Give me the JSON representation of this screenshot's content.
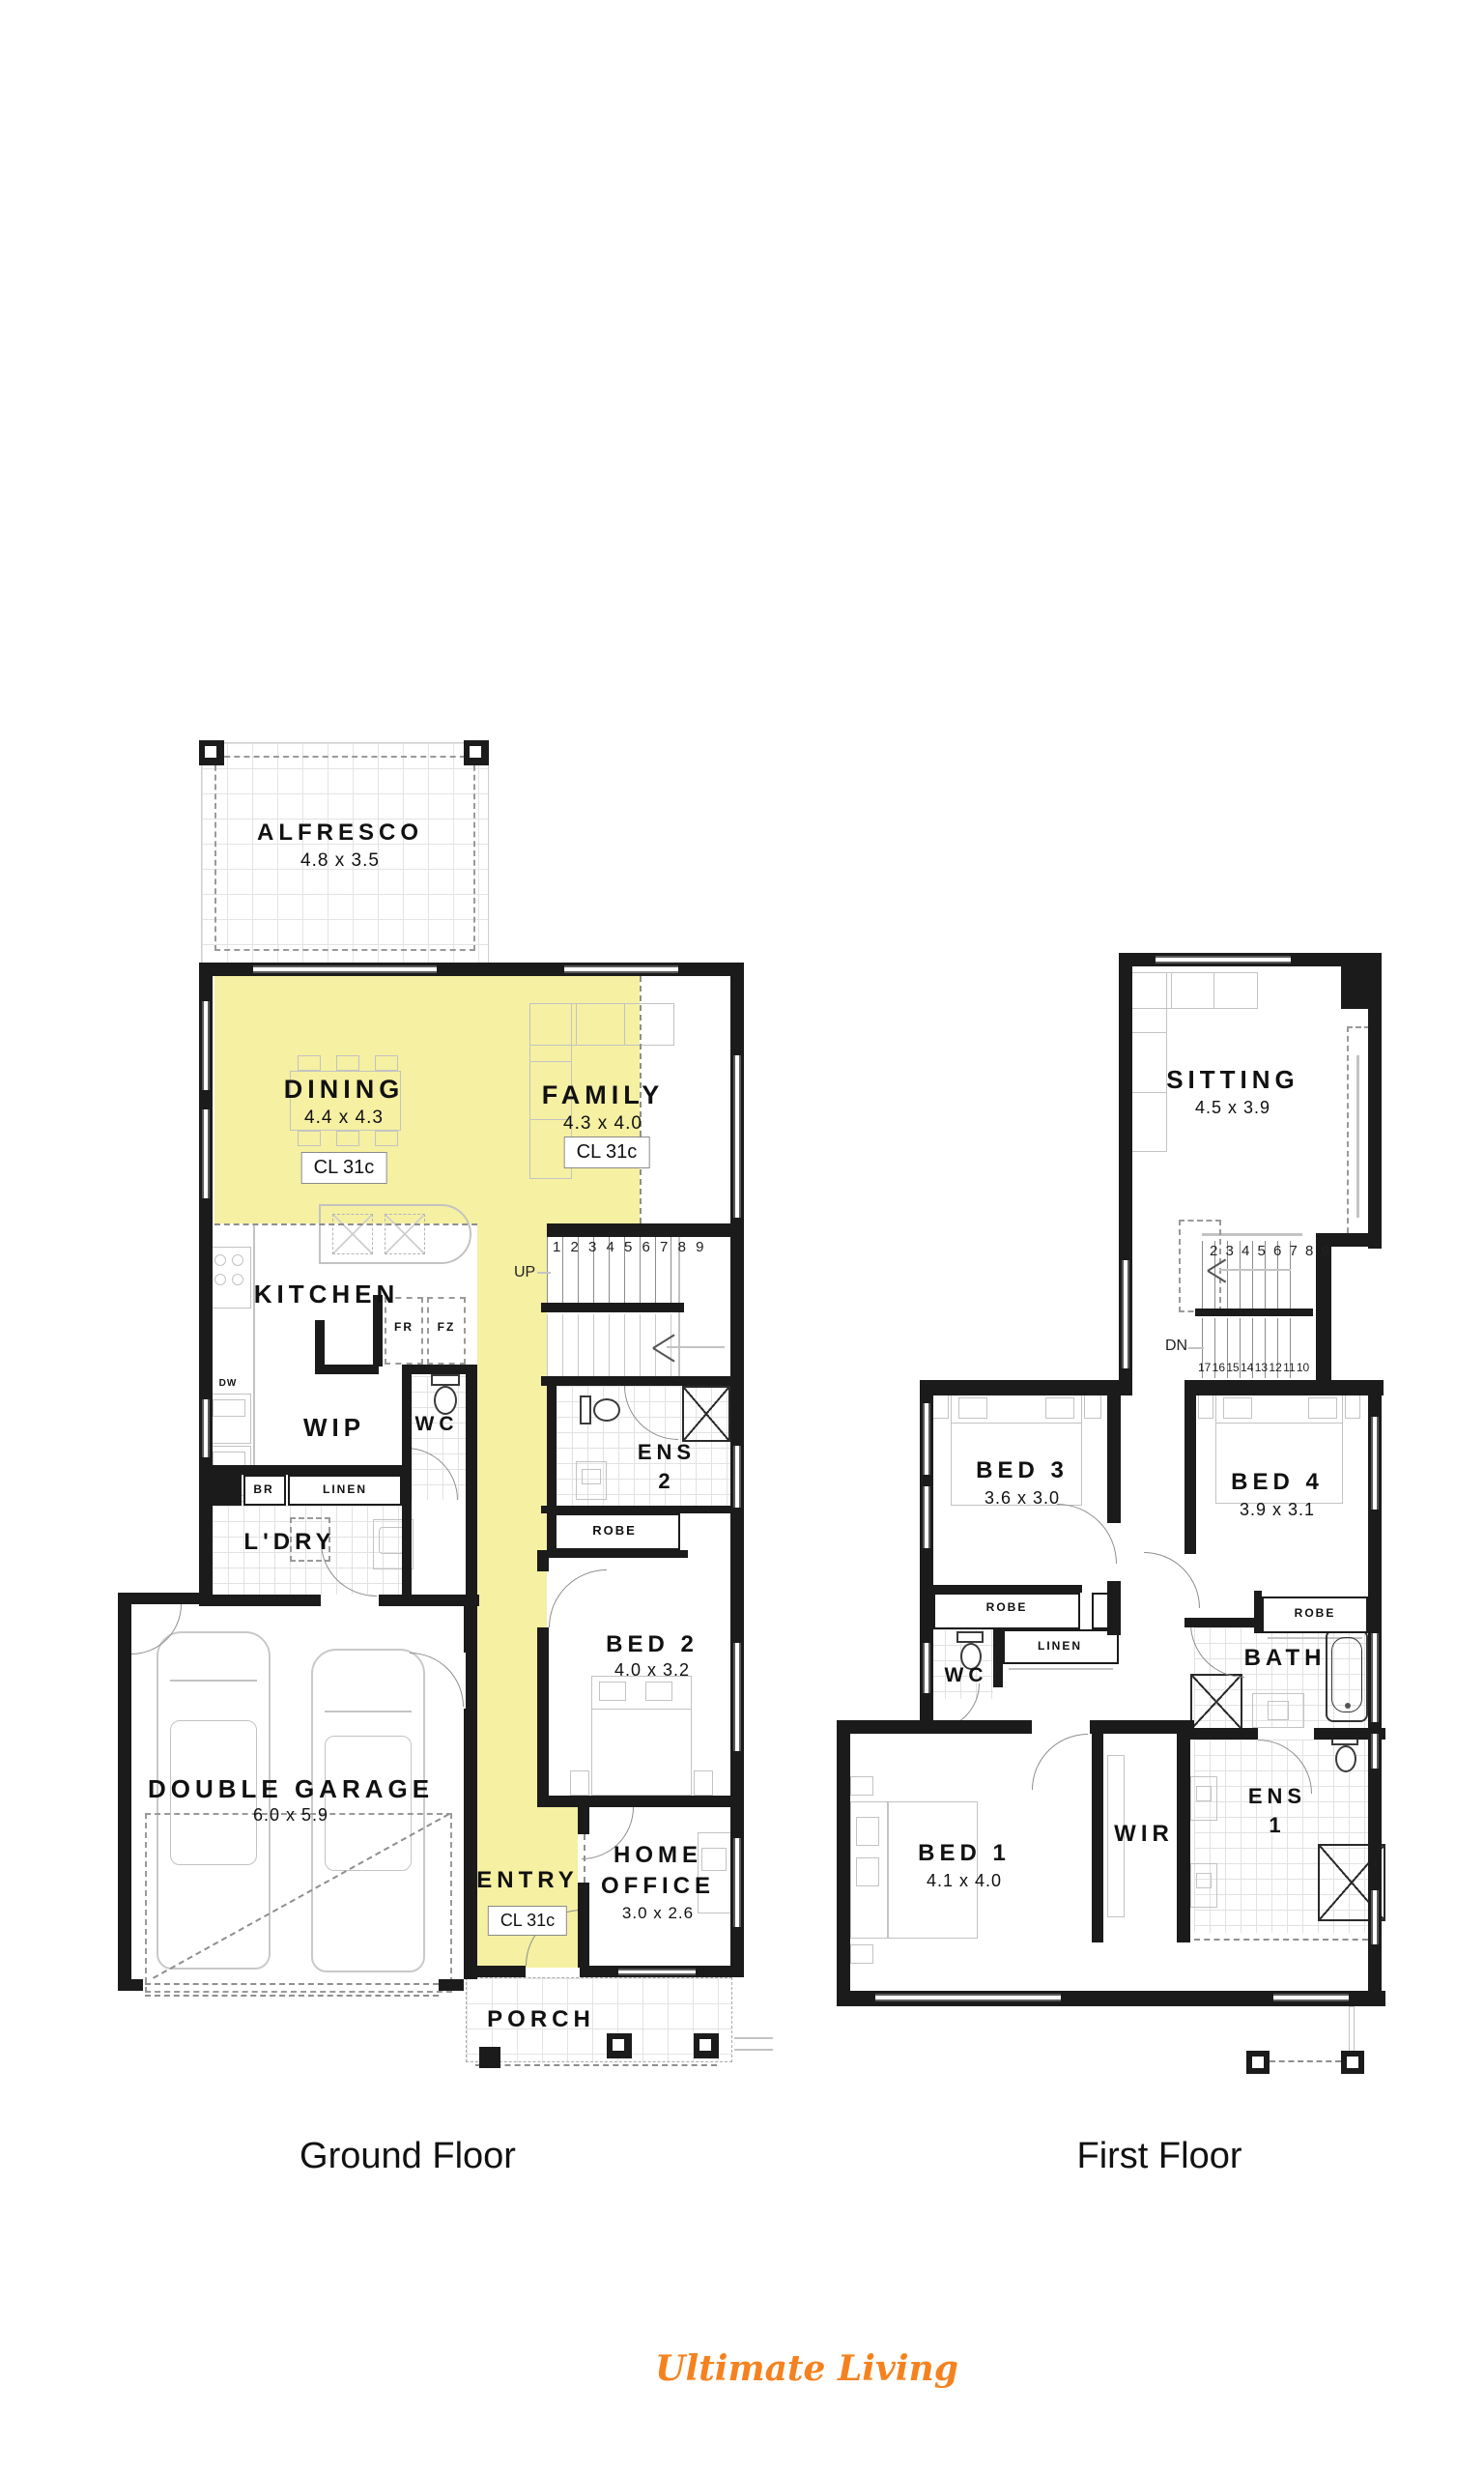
{
  "page": {
    "background": "#ffffff"
  },
  "brand": {
    "name": "Ultimate Living",
    "color": "#f5821f"
  },
  "highlight_color": "#f5f0a2",
  "ground_floor": {
    "caption": "Ground Floor",
    "alfresco": {
      "name": "ALFRESCO",
      "dim": "4.8 x 3.5"
    },
    "dining": {
      "name": "DINING",
      "dim": "4.4 x 4.3",
      "ceiling": "CL 31c"
    },
    "family": {
      "name": "FAMILY",
      "dim": "4.3 x 4.0",
      "ceiling": "CL 31c"
    },
    "kitchen": {
      "name": "KITCHEN"
    },
    "wip": {
      "name": "WIP"
    },
    "wc": {
      "name": "WC"
    },
    "ldry": {
      "name": "L'DRY"
    },
    "br": "BR",
    "linen": "LINEN",
    "fr": "FR",
    "fz": "FZ",
    "dw": "DW",
    "ens2": {
      "line1": "ENS",
      "line2": "2"
    },
    "robe": "ROBE",
    "bed2": {
      "name": "BED 2",
      "dim": "4.0 x 3.2"
    },
    "garage": {
      "name": "DOUBLE GARAGE",
      "dim": "6.0 x 5.9"
    },
    "entry": {
      "name": "ENTRY",
      "ceiling": "CL 31c"
    },
    "home_office": {
      "line1": "HOME",
      "line2": "OFFICE",
      "dim": "3.0 x 2.6"
    },
    "porch": {
      "name": "PORCH"
    },
    "stairs": {
      "up": "UP",
      "numbers": "1 2 3 4 5 6 7 8 9"
    }
  },
  "first_floor": {
    "caption": "First Floor",
    "sitting": {
      "name": "SITTING",
      "dim": "4.5 x 3.9"
    },
    "stairs": {
      "dn": "DN",
      "numbers_up": "2 3 4 5 6 7 8 9",
      "numbers_down": "17 16 15 14 13 12 11 10"
    },
    "bed3": {
      "name": "BED 3",
      "dim": "3.6 x 3.0"
    },
    "bed4": {
      "name": "BED 4",
      "dim": "3.9 x 3.1"
    },
    "robe": "ROBE",
    "wc": "WC",
    "linen": "LINEN",
    "bath": "BATH",
    "bed1": {
      "name": "BED 1",
      "dim": "4.1 x 4.0"
    },
    "wir": "WIR",
    "ens1": {
      "line1": "ENS",
      "line2": "1"
    }
  }
}
